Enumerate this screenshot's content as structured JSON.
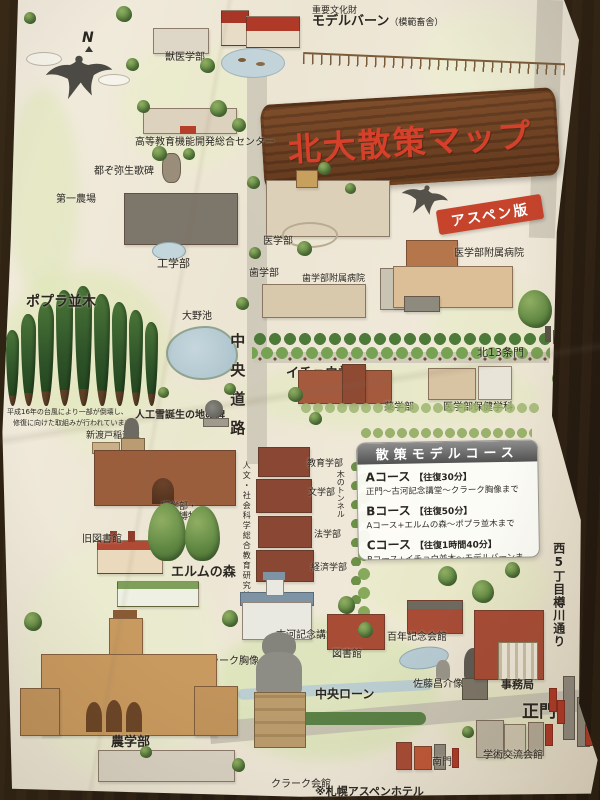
{
  "title": "北大散策マップ",
  "banner": "アスペン版",
  "compass": "N",
  "labels": {
    "important_property": "重要文化財",
    "model_barn": "モデルバーン",
    "model_barn_sub": "（模範畜舎）",
    "vet_school": "獣医学部",
    "higher_ed_center": "高等教育機能開発総合センター",
    "miyako_monument": "都ぞ弥生歌碑",
    "first_farm": "第一農場",
    "engineering": "工学部",
    "medicine": "医学部",
    "dentistry": "歯学部",
    "dental_hospital": "歯学部附属病院",
    "university_hospital": "医学部附属病院",
    "poplar_avenue": "ポプラ並木",
    "ohno_pond": "大野池",
    "central_road": "中央道路",
    "ginkgo_avenue": "イチョウ並木",
    "kita13_gate": "北13条門",
    "pharmacy": "薬学部",
    "health_sciences": "医学部保健学科",
    "artificial_snow_monument": "人工雪誕生の地の碑",
    "nitobe_statue": "新渡戸稲造像",
    "education": "教育学部",
    "letters": "文学部",
    "law": "法学部",
    "economics": "経済学部",
    "tree_tunnel": "木のトンネル",
    "science_museum_l1": "理学部・",
    "science_museum_l2": "総合博物館",
    "old_library": "旧図書館",
    "elm_forest": "エルムの森",
    "humanities_building": "人文・社会科学総合教育研究棟",
    "furukawa_hall": "古河記念講堂",
    "library": "図書館",
    "clark_bust": "クラーク胸像",
    "clark_bust_marker": "●",
    "central_lawn": "中央ローン",
    "centennial_hall": "百年記念会館",
    "sato_statue": "佐藤昌介像",
    "admin_office": "事務局",
    "main_gate": "正門",
    "agriculture": "農学部",
    "clark_hall": "クラーク会館",
    "south_gate": "南門",
    "academic_exchange_hall": "学術交流会館",
    "west5_street": "西5丁目樽川通り"
  },
  "notes": {
    "storm_l1": "平成16年の台風により一部が倒壊し、",
    "storm_l2": "修復に向けた取組みが行われています。",
    "footer": "※札幌アスペンホテル"
  },
  "course_panel": {
    "header": "散策モデルコース",
    "courses": [
      {
        "name": "Aコース",
        "time": "【往復30分】",
        "route": "正門〜古河記念講堂〜クラーク胸像まで"
      },
      {
        "name": "Bコース",
        "time": "【往復50分】",
        "route": "Aコース+エルムの森〜ポプラ並木まで"
      },
      {
        "name": "Cコース",
        "time": "【往復1時間40分】",
        "route": "Bコース+イチョウ並木〜モデルバーンまで"
      }
    ]
  },
  "colors": {
    "paper": "#efe8d9",
    "wood_table": "#241a10",
    "sign_wood": "#6f4223",
    "title_red": "#d6402b",
    "banner_red": "#c6432c",
    "panel_header_gray": "#5f5f5f",
    "brick_red": "#a84c36",
    "poplar_green": "#2f5429",
    "tree_green": "#5f8742",
    "water_blue": "#b7cbd3",
    "road_gray": "#cbc5b6"
  }
}
